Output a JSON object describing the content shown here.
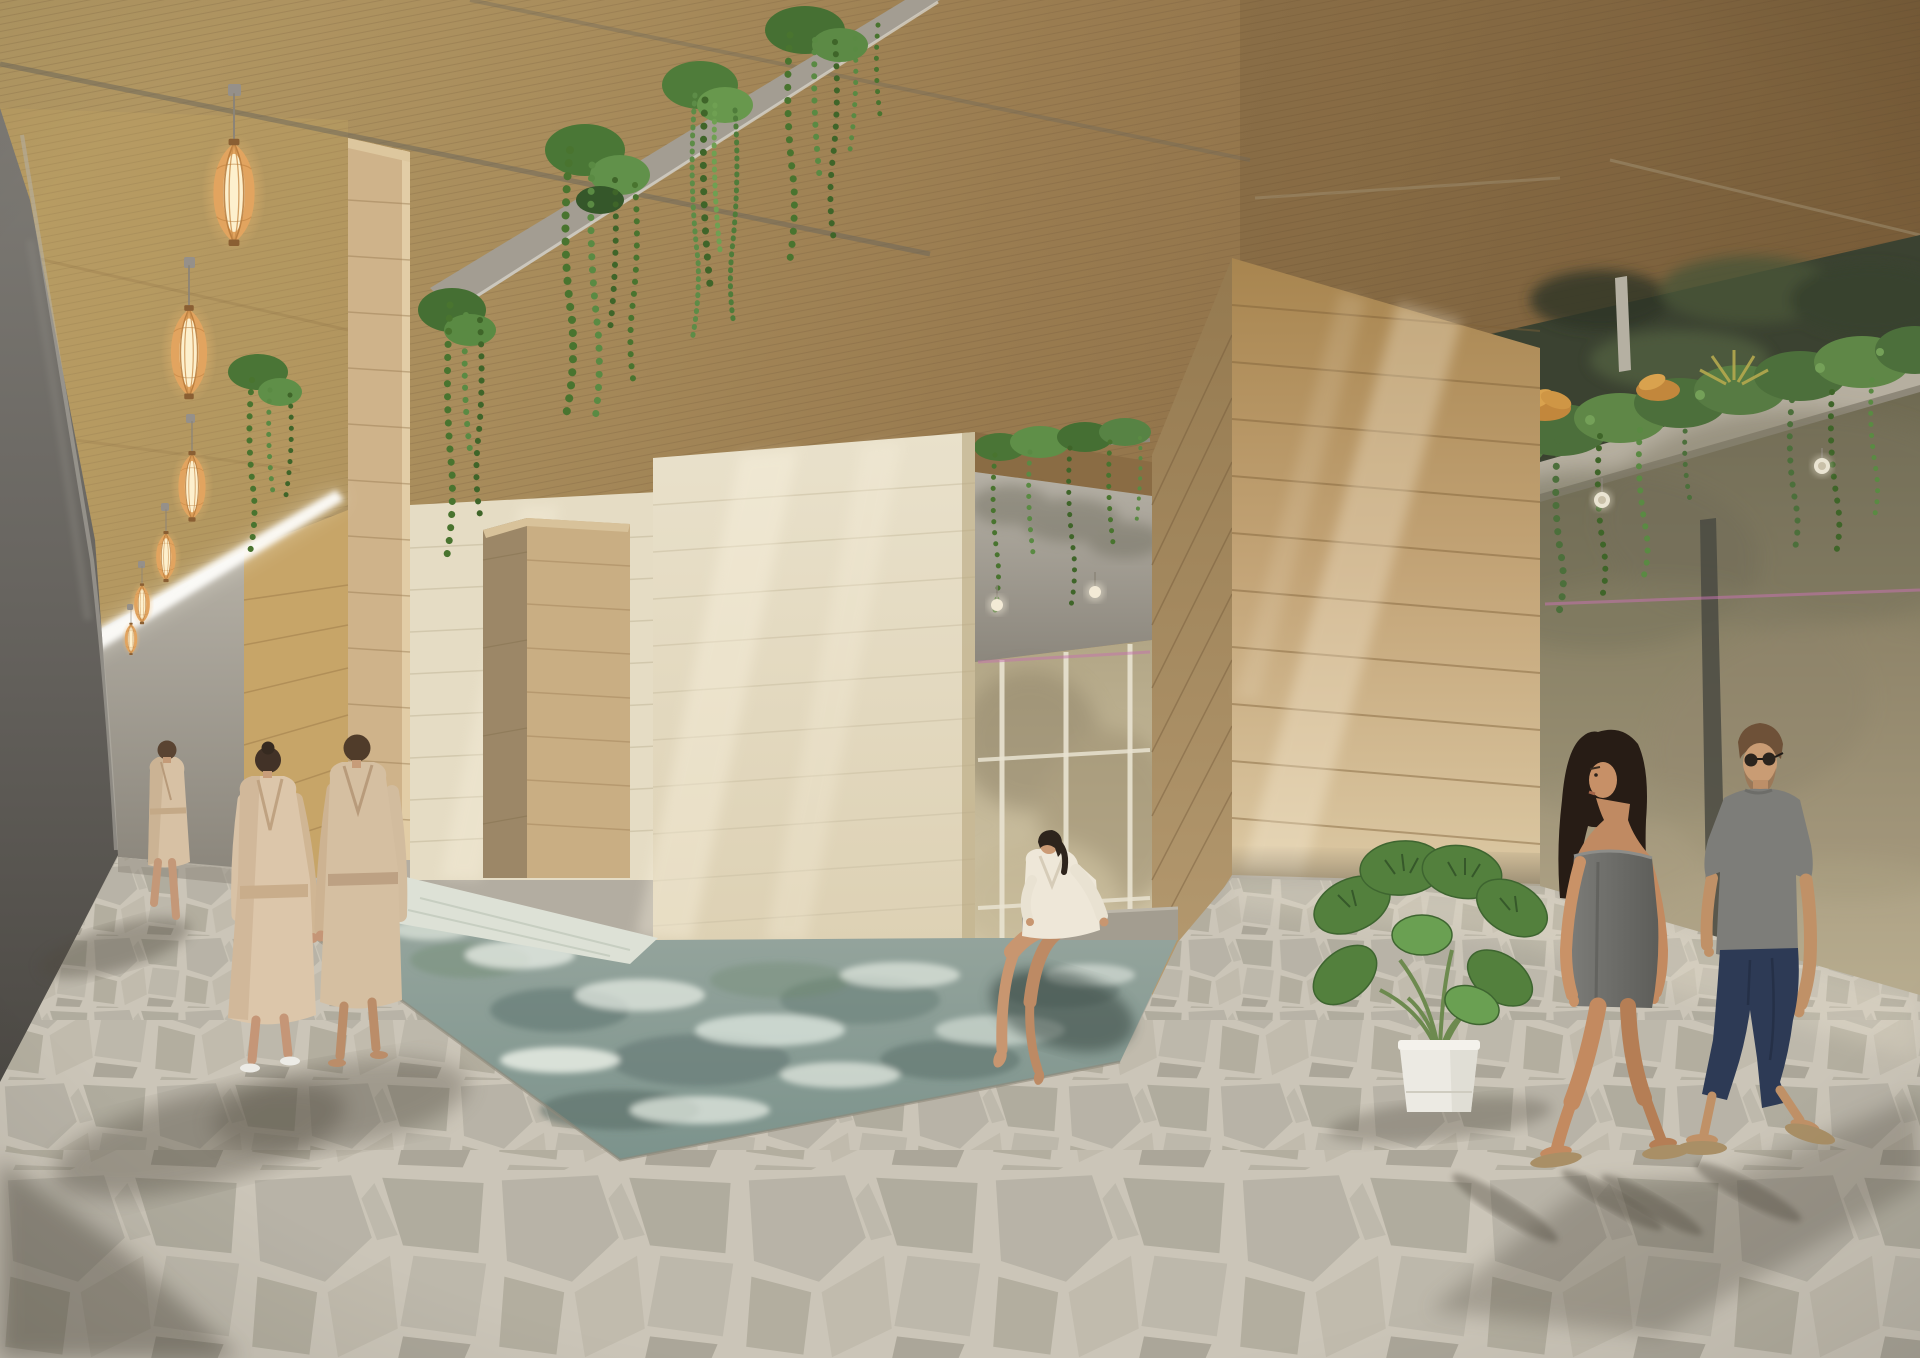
{
  "scene": {
    "kind": "architectural-rendering",
    "description": "Spa interior with wood plank walls and ceiling, sunken pool, flagstone floor, hanging plants and glass wall onto a rock canyon",
    "people_count": 7,
    "pendant_lamp_count": 6
  },
  "labels": {
    "scene": "spa interior rendering",
    "ceiling": "wood plank ceiling",
    "ceiling_beam": "concrete ceiling beam with hanging vines",
    "hanging_vines": "trailing vines hanging from ceiling",
    "pendant_lamps": "row of six wooden slat pendant lanterns",
    "concrete_wall": "dark concrete wall, left side",
    "skylight_streak": "bright skylight streak along corridor wall",
    "corridor_end_wall": "far concrete wall of left corridor",
    "corridor_wood_wall": "wood plank corridor wall",
    "pool_enclosure": "pale wood walls around sunken pool",
    "right_wall": "large wood plank wall with sun ray",
    "opening": "opening to second pool hall with tall windows",
    "windows": "tall windows with rock canyon view",
    "planter_ledge": "concrete ledge with planters and trailing plants",
    "glass_wall": "glass wall with canyon and water view",
    "pool": "sunken pool with rippling water",
    "floor": "gray flagstone floor",
    "monstera": "potted monstera plant in white pot",
    "walker": "man in bathrobe walking away in corridor",
    "robed_couple": "couple in beige bathrobes walking away",
    "sitting_woman": "woman in white robe sitting at pool edge",
    "right_couple": "couple walking past glass wall",
    "shadows": "cast shadows on floor"
  },
  "palette": {
    "ceiling_wood": "#9a7c50",
    "corridor_wood": "#c7a568",
    "pale_wall": "#e5dcc4",
    "big_wall_wood": "#c3a477",
    "concrete": "#6f6c66",
    "water": "#87a09a",
    "water_highlight": "#e9efe7",
    "floor": "#b3ada1",
    "grout": "#c9c3b6",
    "robe_beige": "#d8c2a6",
    "white_robe": "#eee7d8",
    "towel_gray": "#6f6e6a",
    "tshirt_gray": "#7d7d79",
    "pants_navy": "#2d3a55",
    "skin_tan": "#c38a60",
    "foliage": "#4a7536",
    "foliage_light": "#6aa052",
    "bromeliad_orange": "#c2873c",
    "lamp_glow": "#fdf0cd",
    "lamp_wood": "#e2a45f",
    "accent_pink": "#c473ae",
    "cliff_haze": "#958a70"
  }
}
